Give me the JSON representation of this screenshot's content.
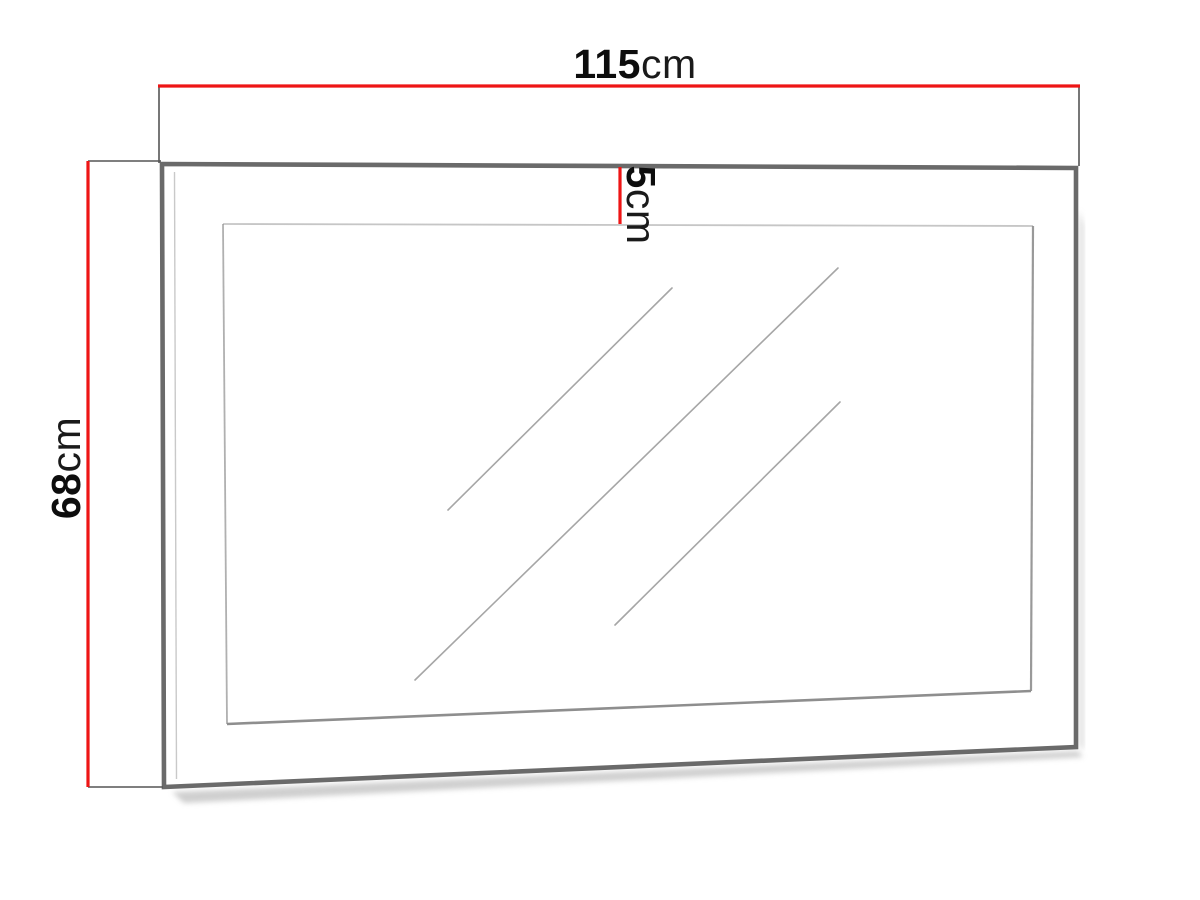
{
  "diagram": {
    "type": "product-dimension-drawing",
    "subject": "wall-mirror",
    "dimensions": {
      "width": {
        "value": "115",
        "unit": "cm"
      },
      "height": {
        "value": "68",
        "unit": "cm"
      },
      "depth": {
        "value": "5",
        "unit": "cm"
      }
    },
    "colors": {
      "dimension_line": "#ee1515",
      "extension_line": "#555555",
      "frame": "#6a6a6a",
      "mirror_edge": "#8e8e8e",
      "reflection_line": "#a6a6a6",
      "label_text": "#0d0d0d",
      "background": "#ffffff"
    }
  }
}
